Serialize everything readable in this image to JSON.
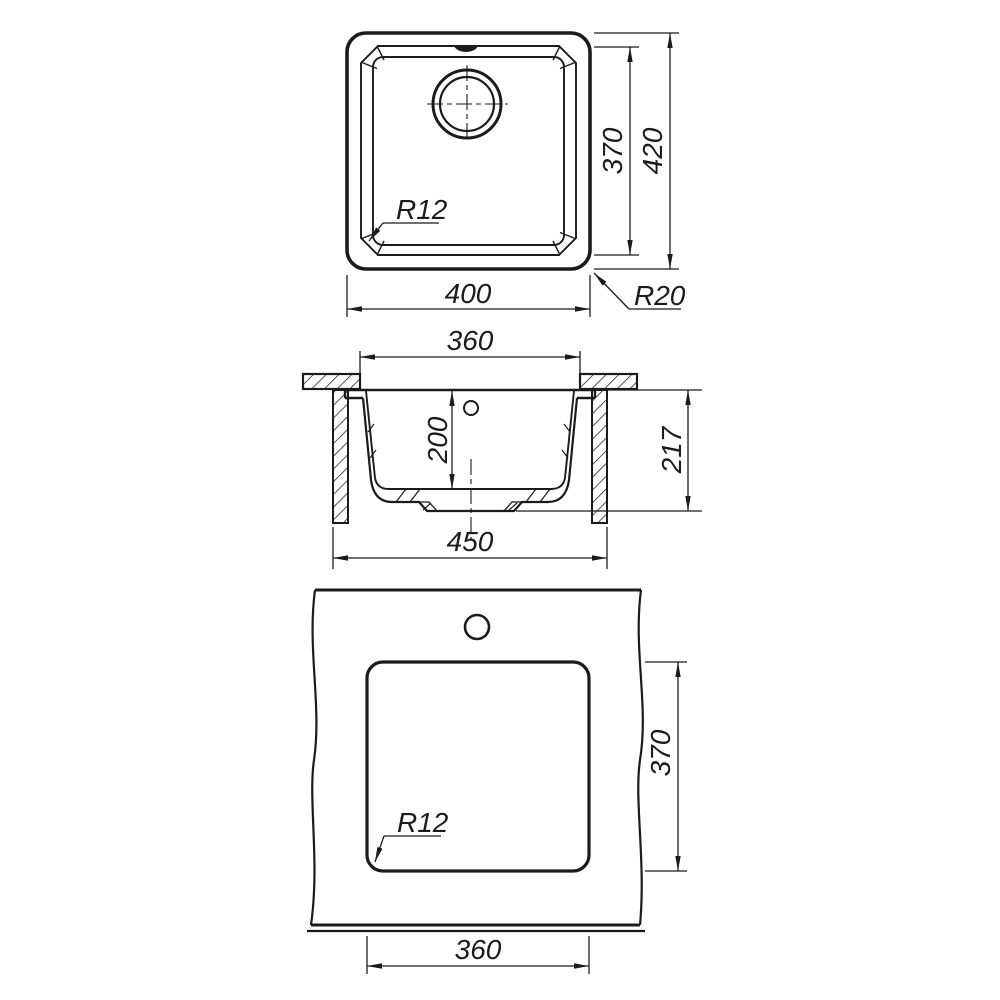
{
  "title": "Sink installation technical drawing",
  "colors": {
    "line": "#1b1b1b",
    "background": "#ffffff"
  },
  "top_view": {
    "width": "400",
    "bowl_height": "370",
    "outer_height": "420",
    "bowl_corner_radius": "R12",
    "outer_corner_radius": "R20"
  },
  "section_view": {
    "bowl_top_width": "360",
    "bowl_depth": "200",
    "overall_height": "217",
    "base_width": "450"
  },
  "cutout_view": {
    "cutout_height": "370",
    "cutout_width": "360",
    "cutout_corner_radius": "R12"
  }
}
